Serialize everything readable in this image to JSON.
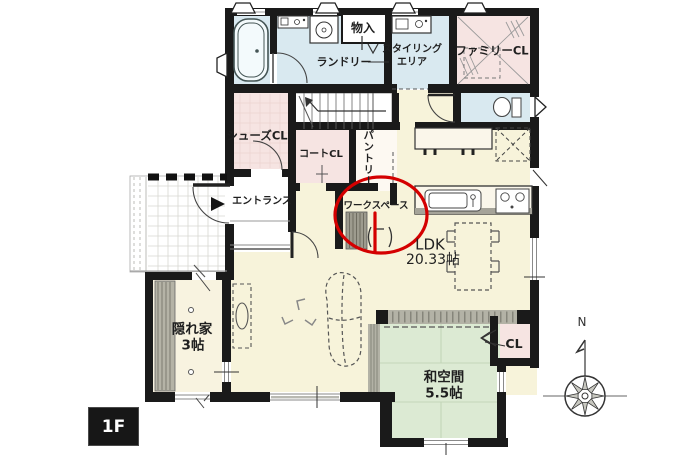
{
  "plan": {
    "floor_badge": "1F",
    "compass_north": "N",
    "labels": {
      "storage": "物入",
      "laundry": "ランドリー",
      "styling_area_line1": "スタイリング",
      "styling_area_line2": "エリア",
      "family_closet": "ファミリーCL",
      "shoes_closet": "シューズCL",
      "coat_closet": "コートCL",
      "pantry": "パントリー",
      "entrance": "エントランス",
      "workspace": "ワークスペース",
      "ldk_name": "LDK",
      "ldk_size": "20.33帖",
      "hideaway_name": "隠れ家",
      "hideaway_size": "3帖",
      "japanese_room_name": "和空間",
      "japanese_room_size": "5.5帖",
      "closet": "CL"
    },
    "annotation": {
      "color": "#d40000"
    },
    "colors": {
      "wall": "#1a1a1a",
      "wet_room_blue": "#d9e9f0",
      "closet_pink": "#f6e4e2",
      "ldk_cream": "#f7f3da",
      "tatami_green": "#dcead3",
      "deck_gray": "#b3b2a6"
    }
  }
}
